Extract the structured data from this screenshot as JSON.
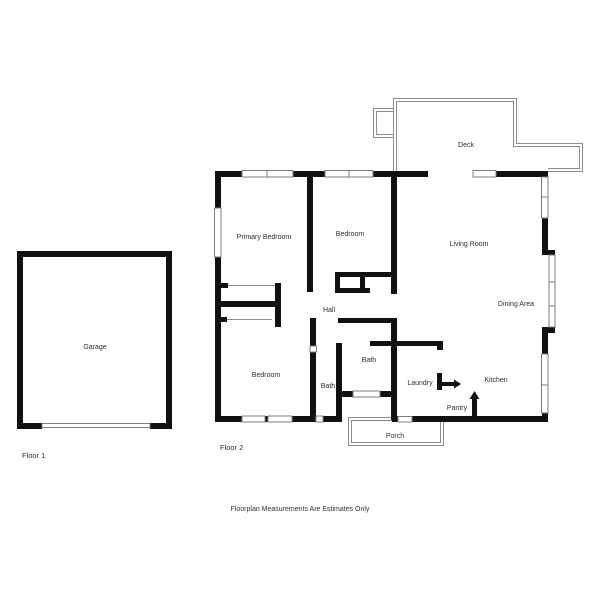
{
  "rooms": {
    "deck": "Deck",
    "primary_bedroom": "Primary Bedroom",
    "bedroom_top": "Bedroom",
    "living_room": "Living Room",
    "dining_area": "Dining Area",
    "hall": "Hall",
    "bedroom_lower": "Bedroom",
    "bath_lower": "Bath",
    "bath_main": "Bath",
    "laundry": "Laundry",
    "kitchen": "Kitchen",
    "pantry": "Pantry",
    "porch": "Porch",
    "garage": "Garage"
  },
  "floors": {
    "floor1": "Floor 1",
    "floor2": "Floor 2"
  },
  "footer": {
    "disclaimer": "Floorplan Measurements Are Estimates Only"
  },
  "colors": {
    "wall": "#111111",
    "outline": "#8c8c8c",
    "window_stroke": "#7d7d7d",
    "label_text": "#2e2e2e",
    "background": "#ffffff"
  }
}
